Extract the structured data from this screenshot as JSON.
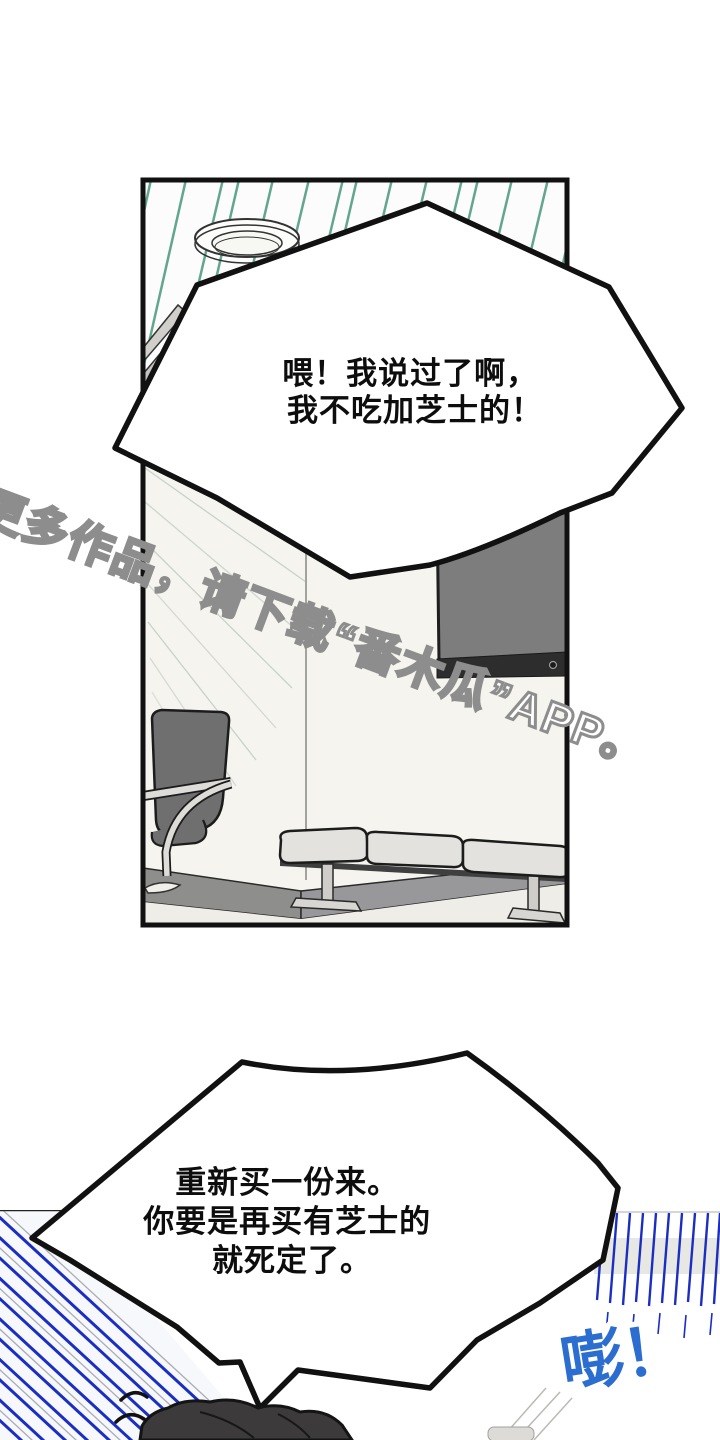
{
  "scene": {
    "kind": "webtoon-comic-page",
    "background_color": "#ffffff"
  },
  "bubble_top": {
    "lines": [
      "喂！我说过了啊，",
      "我不吃加芝士的！"
    ]
  },
  "bubble_bottom": {
    "lines": [
      "重新买一份来。",
      "你要是再买有芝士的",
      "就死定了。"
    ]
  },
  "watermark": {
    "text": "更多作品，请下载“番木瓜”APP。"
  },
  "sfx": {
    "text": "嘭！",
    "color": "#2b6ed0"
  },
  "colors": {
    "outline": "#111111",
    "ceiling_stripe": "#63a690",
    "wall": "#f5f4ef",
    "wall_corner": "#a3a39e",
    "baseboard": "#8e8e8c",
    "floor": "#efede7",
    "tv_screen": "#7d7d7d",
    "tv_bezel": "#2d2d2d",
    "chair": "#6f6f6f",
    "bench_cushion": "#e4e2de",
    "bench_leg": "#d8d6d2",
    "speedline_blue": "#1b2ec2",
    "hair": "#3c3a3b"
  }
}
